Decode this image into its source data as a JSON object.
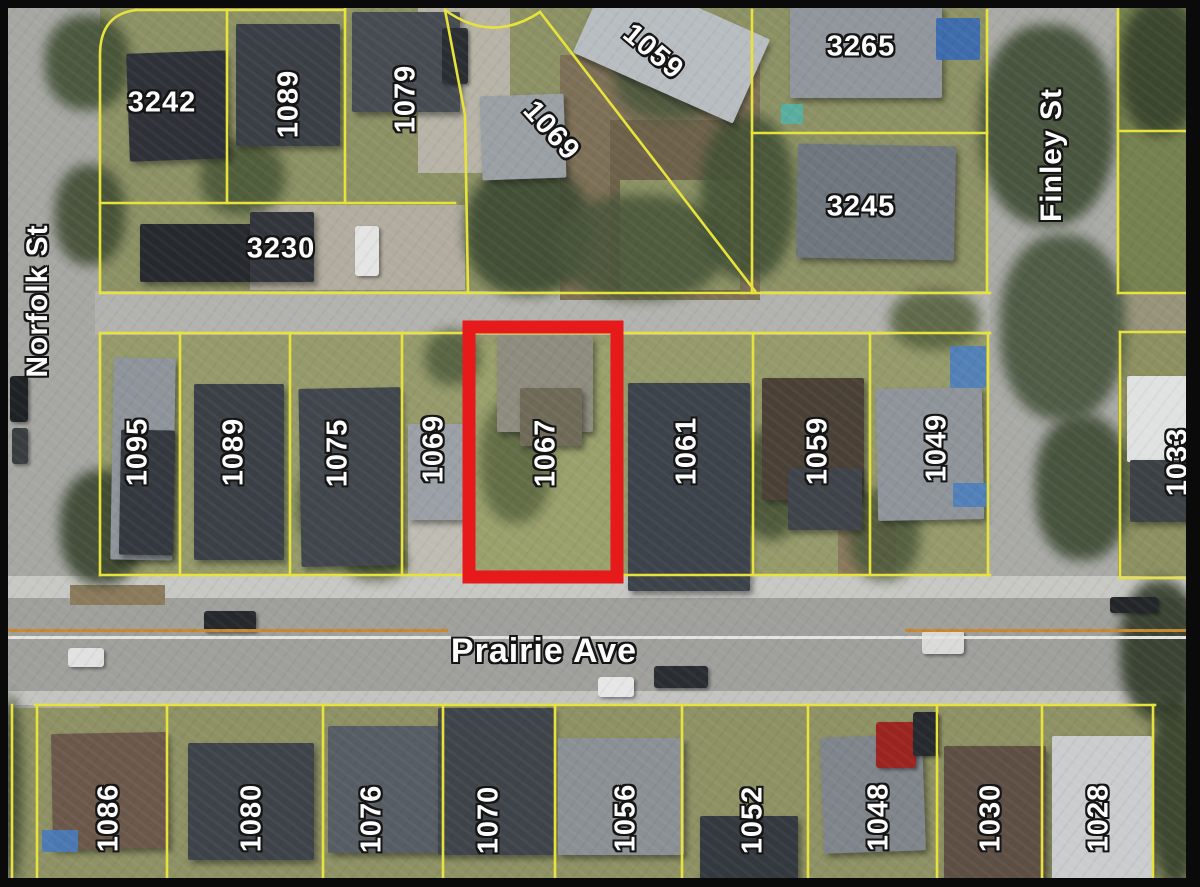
{
  "map": {
    "type": "aerial-parcel-map",
    "colors": {
      "parcel_line": "#e8e33c",
      "highlight_box": "#e6191b",
      "label_fill": "#fdfdfd",
      "label_outline": "#141414",
      "frame": "#0a0a0a"
    },
    "streets": [
      {
        "id": "norfolk",
        "name": "Norfolk St",
        "x": 38,
        "y": 301,
        "rotation": -90,
        "font_size": 30
      },
      {
        "id": "finley",
        "name": "Finley St",
        "x": 1052,
        "y": 155,
        "rotation": -90,
        "font_size": 30
      },
      {
        "id": "prairie",
        "name": "Prairie Ave",
        "x": 544,
        "y": 651,
        "rotation": 0,
        "font_size": 34
      }
    ],
    "highlighted_parcel": {
      "number": "1067",
      "x": 469,
      "y": 327,
      "width": 148,
      "height": 250
    },
    "parcel_labels": [
      {
        "number": "3242",
        "x": 162,
        "y": 103,
        "rotation": 0
      },
      {
        "number": "1089",
        "x": 289,
        "y": 104,
        "rotation": -90
      },
      {
        "number": "1079",
        "x": 406,
        "y": 99,
        "rotation": -90
      },
      {
        "number": "1069",
        "x": 551,
        "y": 131,
        "rotation": 48
      },
      {
        "number": "1059",
        "x": 653,
        "y": 52,
        "rotation": 40
      },
      {
        "number": "3265",
        "x": 861,
        "y": 47,
        "rotation": 0
      },
      {
        "number": "3245",
        "x": 861,
        "y": 207,
        "rotation": 0
      },
      {
        "number": "3230",
        "x": 281,
        "y": 249,
        "rotation": 0
      },
      {
        "number": "1095",
        "x": 138,
        "y": 452,
        "rotation": -90
      },
      {
        "number": "1089",
        "x": 234,
        "y": 452,
        "rotation": -90
      },
      {
        "number": "1075",
        "x": 338,
        "y": 453,
        "rotation": -90
      },
      {
        "number": "1069",
        "x": 434,
        "y": 449,
        "rotation": -90
      },
      {
        "number": "1067",
        "x": 546,
        "y": 453,
        "rotation": -90
      },
      {
        "number": "1061",
        "x": 687,
        "y": 451,
        "rotation": -90
      },
      {
        "number": "1059",
        "x": 818,
        "y": 451,
        "rotation": -90
      },
      {
        "number": "1049",
        "x": 937,
        "y": 448,
        "rotation": -90
      },
      {
        "number": "1033",
        "x": 1178,
        "y": 462,
        "rotation": -90
      },
      {
        "number": "1086",
        "x": 109,
        "y": 818,
        "rotation": -90
      },
      {
        "number": "1080",
        "x": 252,
        "y": 818,
        "rotation": -90
      },
      {
        "number": "1076",
        "x": 372,
        "y": 819,
        "rotation": -90
      },
      {
        "number": "1070",
        "x": 489,
        "y": 820,
        "rotation": -90
      },
      {
        "number": "1056",
        "x": 626,
        "y": 818,
        "rotation": -90
      },
      {
        "number": "1052",
        "x": 753,
        "y": 820,
        "rotation": -90
      },
      {
        "number": "1048",
        "x": 879,
        "y": 817,
        "rotation": -90
      },
      {
        "number": "1030",
        "x": 991,
        "y": 818,
        "rotation": -90
      },
      {
        "number": "1028",
        "x": 1099,
        "y": 818,
        "rotation": -90
      }
    ]
  }
}
